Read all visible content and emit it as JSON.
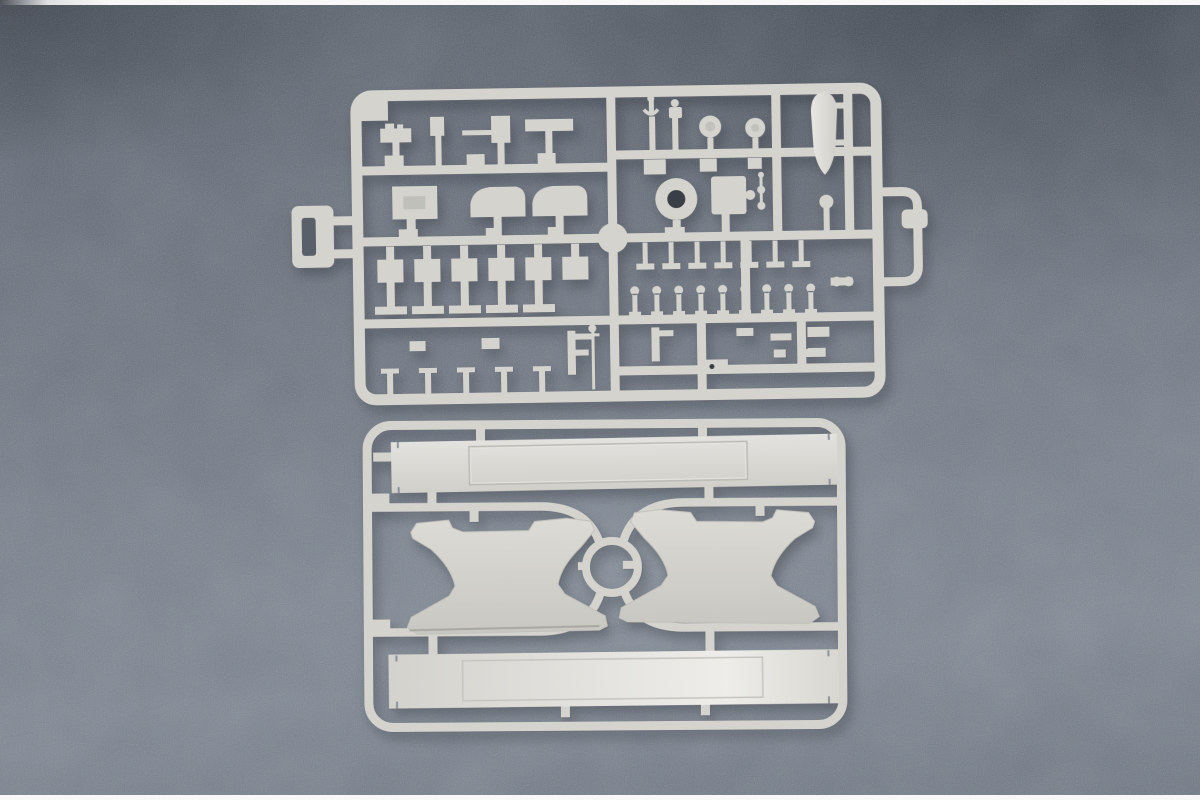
{
  "meta": {
    "type": "product-photograph",
    "subject": "Plastic model kit sprues - two light grey injection-moulded runner frames photographed on a blue-grey flecked backdrop",
    "text_content": "none (no visible text in image)"
  },
  "photo": {
    "edge_strip_top": "white paper edge strip",
    "edge_strip_bottom": "white paper edge strip",
    "backdrop": "mottled blue-grey fabric, darker toward top corners"
  },
  "sprues": {
    "detail_sprue": {
      "position": "top",
      "description": "Rectangular runner grid densely packed with small ship fittings",
      "parts": [
        "ship's boat hull",
        "funnel ring with dark bore",
        "two ventilator domes",
        "gun mount with barrel",
        "barrel sleeve",
        "searchlight discs",
        "equipment box",
        "row of hanging T-posts",
        "row of nine bollards",
        "six rectangular fittings",
        "T-foot fittings",
        "I-post fittings",
        "F-shaped bracket",
        "winch drum",
        "hanging label tab (left)",
        "side loop with knob (right)"
      ]
    },
    "hull_sprue": {
      "position": "bottom",
      "description": "Rounded rectangular frame with S-curved runners meeting at a centre ring",
      "parts": [
        "upper deck strip with recessed panel",
        "lower deck strip with recessed panel",
        "left hull bulkhead (hourglass shape)",
        "right hull bulkhead (hourglass shape)",
        "centre ring"
      ]
    }
  },
  "colors": {
    "backdrop_top": "#59606a",
    "backdrop_mid": "#6f7681",
    "backdrop_light": "#7b838e",
    "plastic": "#d4d3ce",
    "plastic_light": "#dfded9",
    "plastic_bright": "#ecebe7",
    "plastic_shadow": "#a9a8a2",
    "hole_dark": "#3a3f47",
    "slot_dark": "#59606a",
    "edge_strip": "#f8f8f8"
  }
}
